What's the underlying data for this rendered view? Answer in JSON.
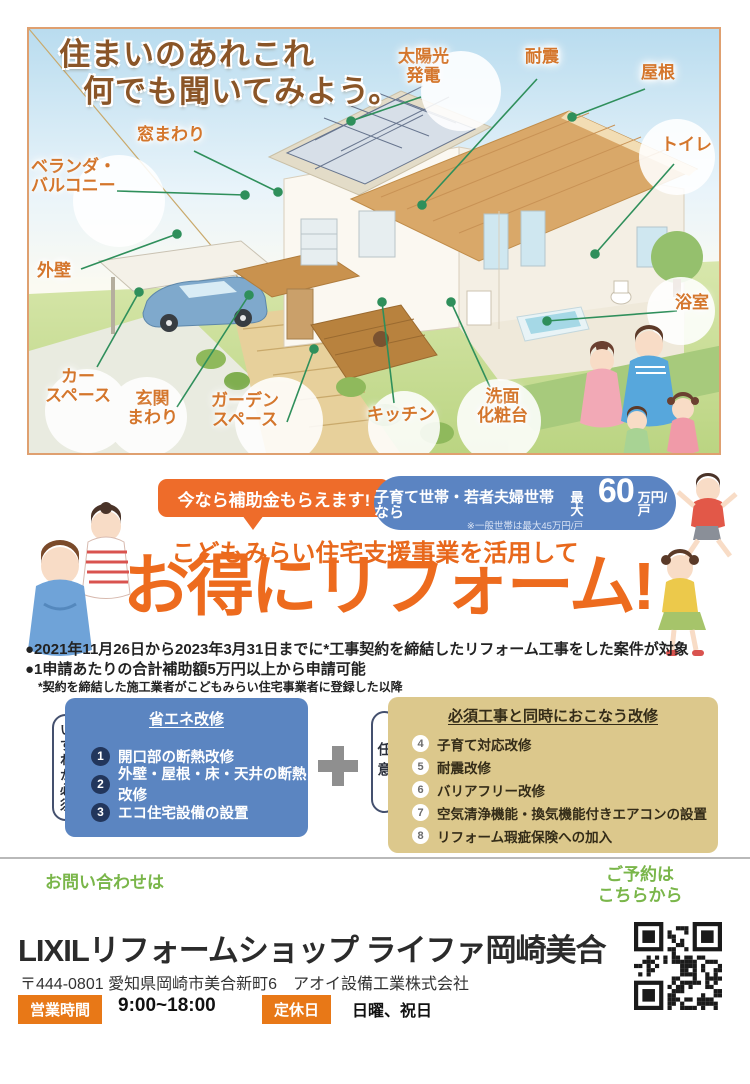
{
  "house": {
    "title_line1": "住まいのあれこれ",
    "title_line2": "何でも聞いてみよう。",
    "labels": [
      {
        "id": "solar",
        "text": "太陽光\n発電"
      },
      {
        "id": "quake",
        "text": "耐震"
      },
      {
        "id": "roof",
        "text": "屋根"
      },
      {
        "id": "toilet",
        "text": "トイレ"
      },
      {
        "id": "window",
        "text": "窓まわり"
      },
      {
        "id": "veranda",
        "text": "ベランダ・\nバルコニー"
      },
      {
        "id": "wall",
        "text": "外壁"
      },
      {
        "id": "carspace",
        "text": "カー\nスペース"
      },
      {
        "id": "entrance",
        "text": "玄関\nまわり"
      },
      {
        "id": "garden",
        "text": "ガーデン\nスペース"
      },
      {
        "id": "kitchen",
        "text": "キッチン"
      },
      {
        "id": "vanity",
        "text": "洗面\n化粧台"
      },
      {
        "id": "bath",
        "text": "浴室"
      }
    ]
  },
  "promo": {
    "bubble": "今なら補助金もらえます!",
    "pill_main": "子育て世帯・若者夫婦世帯なら",
    "pill_max": "最大",
    "pill_amount": "60",
    "pill_unit": "万円/戸",
    "pill_note": "※一般世帯は最大45万円/戸",
    "subtitle": "こどもみらい住宅支援事業を活用して",
    "title": "お得にリフォーム!",
    "bullets": [
      "●2021年11月26日から2023年3月31日までに*工事契約を締結したリフォーム工事をした案件が対象",
      "●1申請あたりの合計補助額5万円以上から申請可能"
    ],
    "note": "*契約を締結した施工業者がこどもみらい住宅事業者に登録した以降"
  },
  "requirements": {
    "left_box": {
      "side_label": "いずれか必須",
      "title": "省エネ改修",
      "items": [
        {
          "num": "1",
          "text": "開口部の断熱改修"
        },
        {
          "num": "2",
          "text": "外壁・屋根・床・天井の断熱改修"
        },
        {
          "num": "3",
          "text": "エコ住宅設備の設置"
        }
      ]
    },
    "plus": "+",
    "right_box": {
      "side_label": "任意",
      "title": "必須工事と同時におこなう改修",
      "items": [
        {
          "num": "4",
          "text": "子育て対応改修"
        },
        {
          "num": "5",
          "text": "耐震改修"
        },
        {
          "num": "6",
          "text": "バリアフリー改修"
        },
        {
          "num": "7",
          "text": "空気清浄機能・換気機能付きエアコンの設置"
        },
        {
          "num": "8",
          "text": "リフォーム瑕疵保険への加入"
        }
      ]
    }
  },
  "footer": {
    "contact_label": "お問い合わせは",
    "reserve_label": "ご予約は\nこちらから",
    "shop_name": "LIXILリフォームショップ ライファ岡崎美合",
    "address": "〒444-0801 愛知県岡崎市美合新町6",
    "company": "アオイ設備工業株式会社",
    "hours_label": "営業時間",
    "hours_value": "9:00~18:00",
    "closed_label": "定休日",
    "closed_value": "日曜、祝日"
  },
  "colors": {
    "accent_orange": "#ed6b1e",
    "label_orange": "#d4762c",
    "title_brown": "#8a5527",
    "blue_box": "#5b85c1",
    "blue_pill": "#5b84c2",
    "tan_box": "#dcc88c",
    "green_text": "#7ab64a",
    "leader_green": "#2f8f5b",
    "badge_orange": "#e87817"
  }
}
